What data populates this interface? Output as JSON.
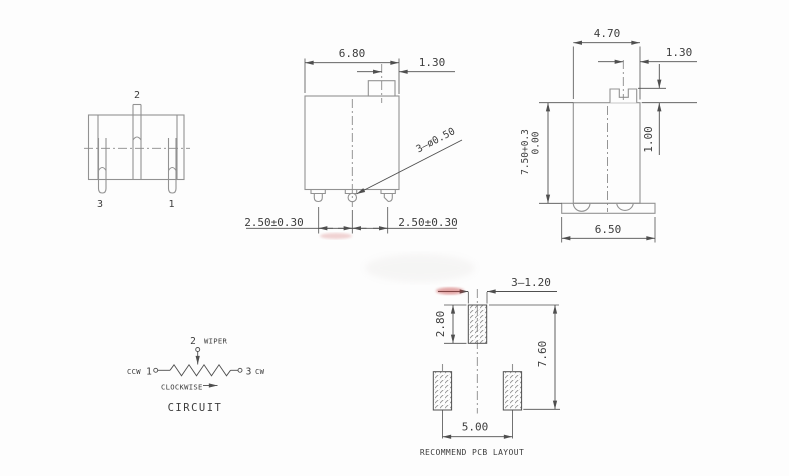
{
  "drawing": {
    "colors": {
      "bg": "#fdfdfd",
      "line": "#929292",
      "dim": "#4f4f4f",
      "text": "#3d3d3d",
      "center": "#8a8a8a",
      "red": "#c23b3b"
    },
    "front_view": {
      "pin_top": "2",
      "pin_left": "3",
      "pin_right": "1"
    },
    "top_view": {
      "body_width": "6.80",
      "tab_offset": "1.30",
      "pin_callout": "3—ø0.50",
      "pitch_left": "2.50±0.30",
      "pitch_right": "2.50±0.30"
    },
    "side_view": {
      "body_width": "4.70",
      "slot_offset": "1.30",
      "boss_height": "1.00",
      "height": "7.50+0.3",
      "height_tol": "0.00",
      "base_width": "6.50"
    },
    "circuit": {
      "pin2": "2",
      "wiper": "WIPER",
      "ccw": "CCW",
      "pin1": "1",
      "pin3": "3",
      "cw": "CW",
      "rotation": "CLOCKWISE",
      "title": "CIRCUIT"
    },
    "pcb": {
      "hole_callout": "3—1.20",
      "pad_height": "2.80",
      "row_spacing": "7.60",
      "pad_spacing": "5.00",
      "title": "RECOMMEND PCB LAYOUT"
    }
  }
}
